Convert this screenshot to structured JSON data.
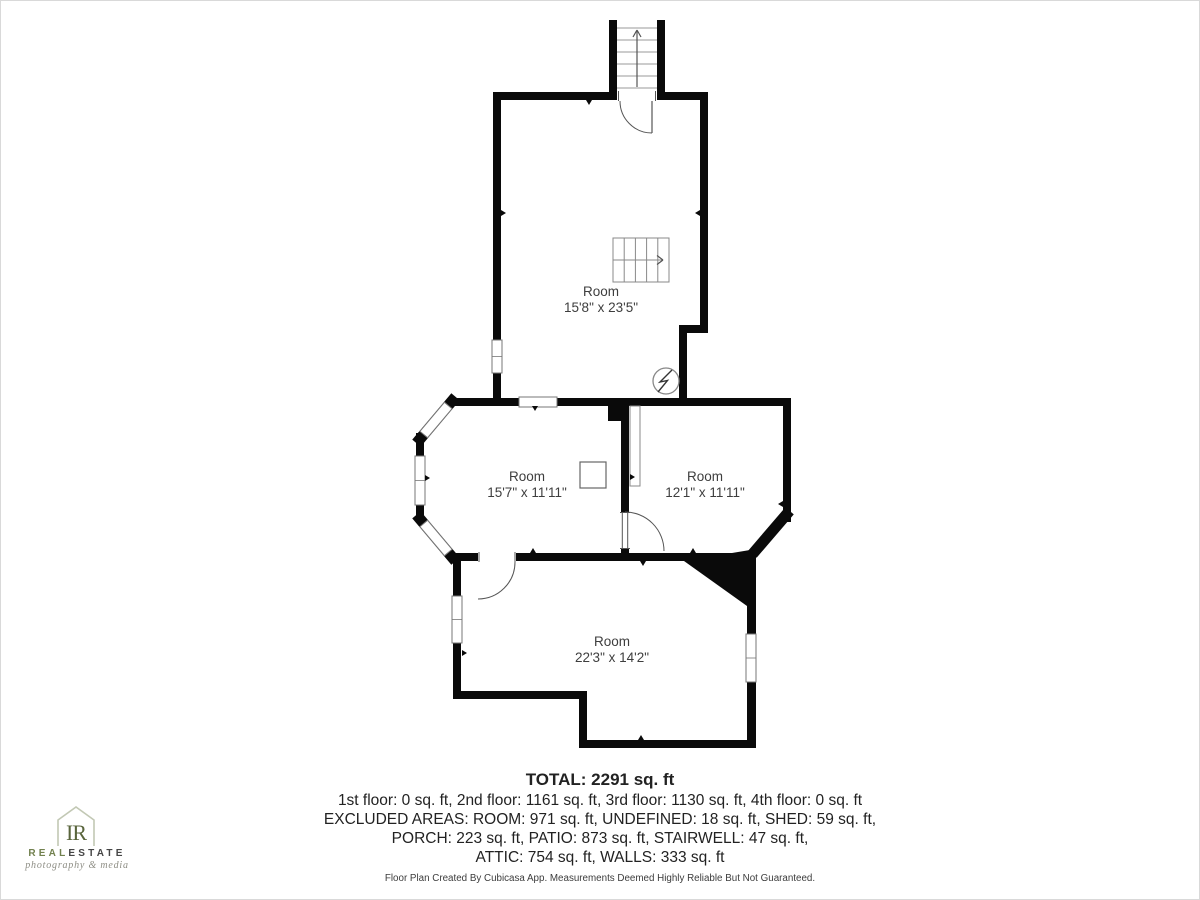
{
  "page": {
    "background": "#ffffff",
    "border_color": "#d9d9d9"
  },
  "plan": {
    "wall_color": "#0a0a0a",
    "line_color": "#888888",
    "label_color": "#3e3e3e",
    "rooms": [
      {
        "name": "Room",
        "dims": "15'8\" x 23'5\""
      },
      {
        "name": "Room",
        "dims": "15'7\" x 11'11\""
      },
      {
        "name": "Room",
        "dims": "12'1\" x 11'11\""
      },
      {
        "name": "Room",
        "dims": "22'3\" x 14'2\""
      }
    ],
    "icons": [
      "stairwell-icon",
      "staircase-icon",
      "electrical-panel-icon",
      "door-arc-icon",
      "window-icon"
    ]
  },
  "summary": {
    "total": "TOTAL: 2291 sq. ft",
    "floors": "1st floor: 0 sq. ft, 2nd floor: 1161 sq. ft, 3rd floor: 1130 sq. ft, 4th floor: 0 sq. ft",
    "excluded_line1": "EXCLUDED AREAS: ROOM: 971 sq. ft, UNDEFINED: 18 sq. ft, SHED: 59 sq. ft,",
    "excluded_line2": "PORCH: 223 sq. ft, PATIO: 873 sq. ft, STAIRWELL: 47 sq. ft,",
    "excluded_line3": "ATTIC: 754 sq. ft, WALLS: 333 sq. ft"
  },
  "footer": {
    "disclaimer": "Floor Plan Created By Cubicasa App. Measurements Deemed Highly Reliable But Not Guaranteed."
  },
  "logo": {
    "monogram": "IR",
    "brand_part1": "REAL",
    "brand_part2": "ESTATE",
    "tagline": "photography & media",
    "green": "#72814f",
    "dark": "#454545",
    "house_outline": "#c2c8b4"
  }
}
